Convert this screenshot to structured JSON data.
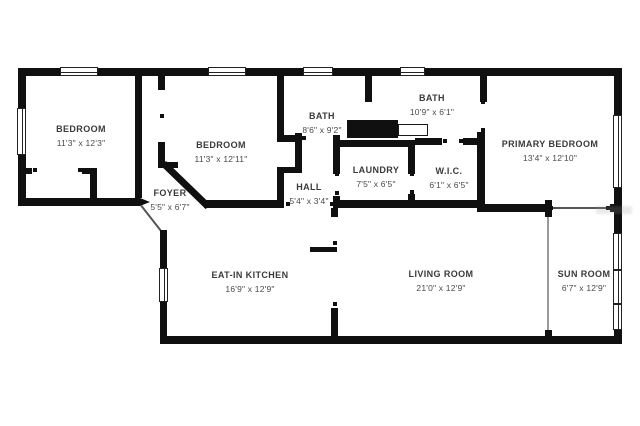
{
  "plan_title": "floor-plan",
  "colors": {
    "wall": "#101010",
    "label": "#3a3a3a",
    "background": "#ffffff"
  },
  "rooms": [
    {
      "name": "BEDROOM",
      "dims": "11'3\" x 12'3\""
    },
    {
      "name": "BEDROOM",
      "dims": "11'3\" x 12'11\""
    },
    {
      "name": "BATH",
      "dims": "8'6\" x 9'2\""
    },
    {
      "name": "BATH",
      "dims": "10'9\" x 6'1\""
    },
    {
      "name": "PRIMARY BEDROOM",
      "dims": "13'4\" x 12'10\""
    },
    {
      "name": "FOYER",
      "dims": "5'5\" x 6'7\""
    },
    {
      "name": "HALL",
      "dims": "5'4\" x 3'4\""
    },
    {
      "name": "LAUNDRY",
      "dims": "7'5\" x 6'5\""
    },
    {
      "name": "W.I.C.",
      "dims": "6'1\" x 6'5\""
    },
    {
      "name": "EAT-IN KITCHEN",
      "dims": "16'9\" x 12'9\""
    },
    {
      "name": "LIVING ROOM",
      "dims": "21'0\" x 12'9\""
    },
    {
      "name": "SUN ROOM",
      "dims": "6'7\" x 12'9\""
    }
  ]
}
